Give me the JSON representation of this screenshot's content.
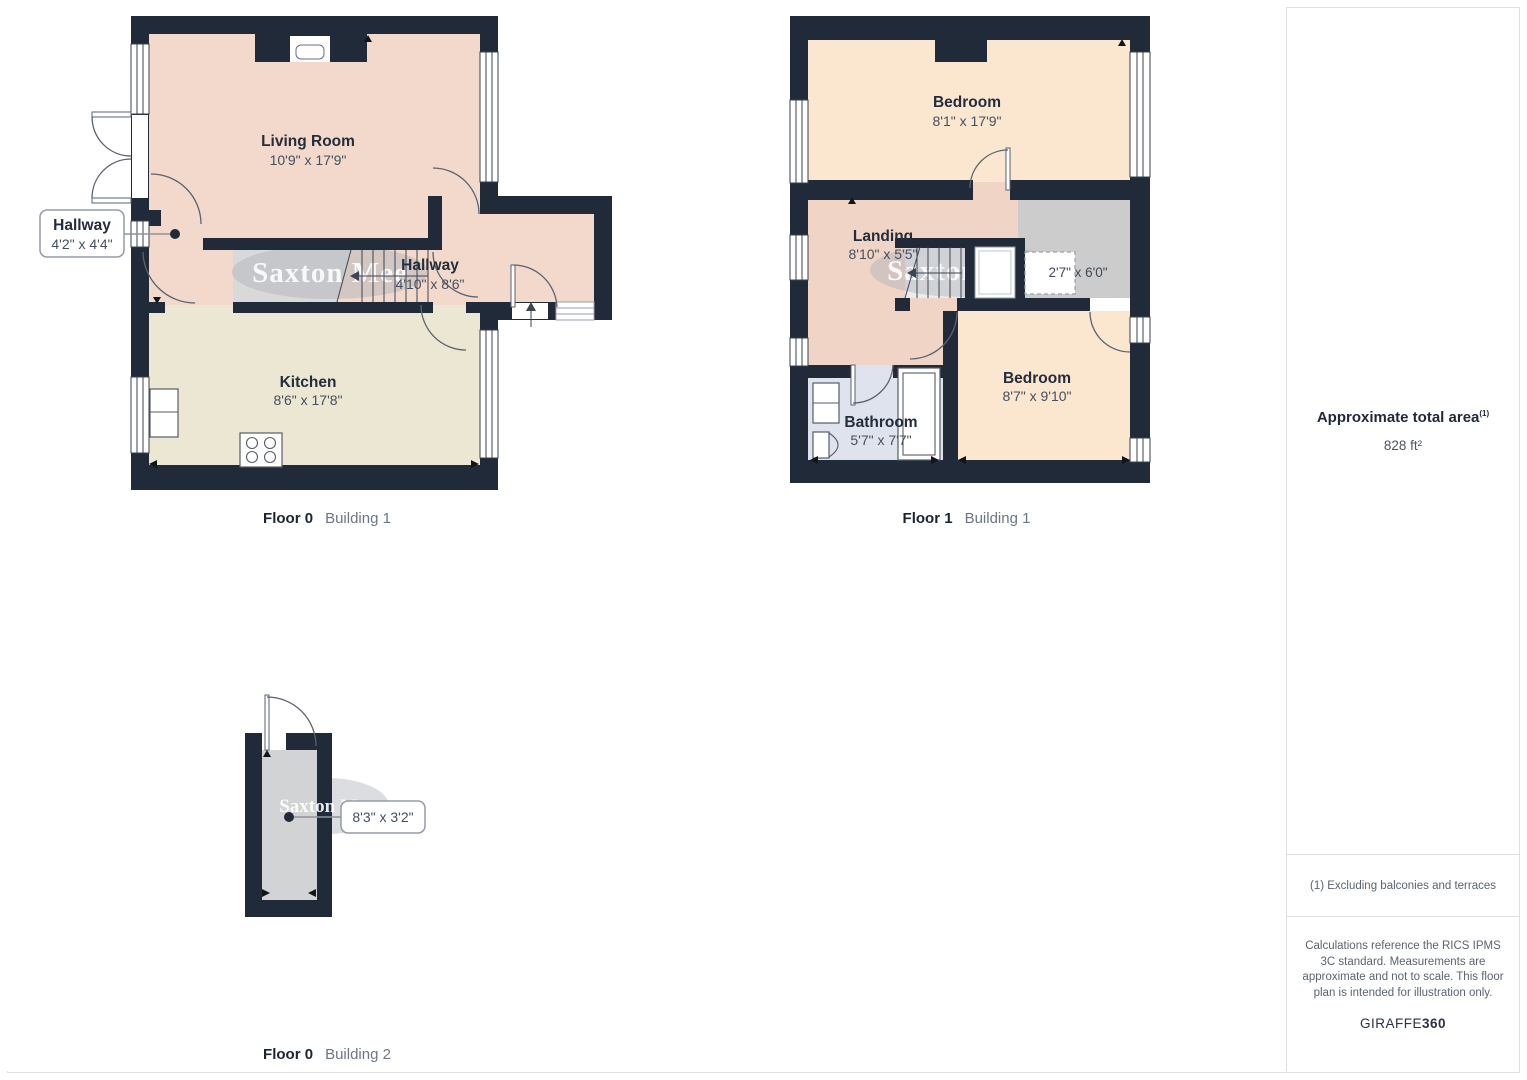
{
  "watermark": "Saxton Mee",
  "panels": {
    "floor0_building1": {
      "caption": {
        "floor": "Floor 0",
        "building": "Building 1"
      },
      "living_room": {
        "name": "Living Room",
        "dims": "10'9\" x 17'9\""
      },
      "hallway_callout": {
        "name": "Hallway",
        "dims": "4'2\" x 4'4\""
      },
      "hallway": {
        "name": "Hallway",
        "dims": "4'10\" x 8'6\""
      },
      "kitchen": {
        "name": "Kitchen",
        "dims": "8'6\" x 17'8\""
      }
    },
    "floor1_building1": {
      "caption": {
        "floor": "Floor 1",
        "building": "Building 1"
      },
      "bedroom_top": {
        "name": "Bedroom",
        "dims": "8'1\" x 17'9\""
      },
      "landing": {
        "name": "Landing",
        "dims": "8'10\" x 5'5\""
      },
      "cupboard": {
        "dims": "2'7\" x 6'0\""
      },
      "bathroom": {
        "name": "Bathroom",
        "dims": "5'7\" x 7'7\""
      },
      "bedroom_bottom": {
        "name": "Bedroom",
        "dims": "8'7\" x 9'10\""
      }
    },
    "floor0_building2": {
      "caption": {
        "floor": "Floor 0",
        "building": "Building 2"
      },
      "store_callout": {
        "dims": "8'3\" x 3'2\""
      }
    }
  },
  "sidebar": {
    "area_title": "Approximate total area",
    "area_sup": "(1)",
    "area_value": "828 ft²",
    "note_exclusions": "(1) Excluding balconies and terraces",
    "disclaimer": "Calculations reference the RICS IPMS 3C standard. Measurements are approximate and not to scale. This floor plan is intended for illustration only.",
    "brand_name": "GIRAFFE",
    "brand_number": "360"
  },
  "colors": {
    "wall": "#212a38",
    "room_pink": "#f2d9cb",
    "room_peach": "#fbe6cf",
    "room_cream": "#ece7d2",
    "room_blue": "#dfe3ed",
    "floor_gray": "#d2d3d5",
    "storage_gray": "#cccccc",
    "panel_border": "#dfdfdf",
    "label_text": "#232d3c",
    "dims_text": "#454f5f"
  }
}
